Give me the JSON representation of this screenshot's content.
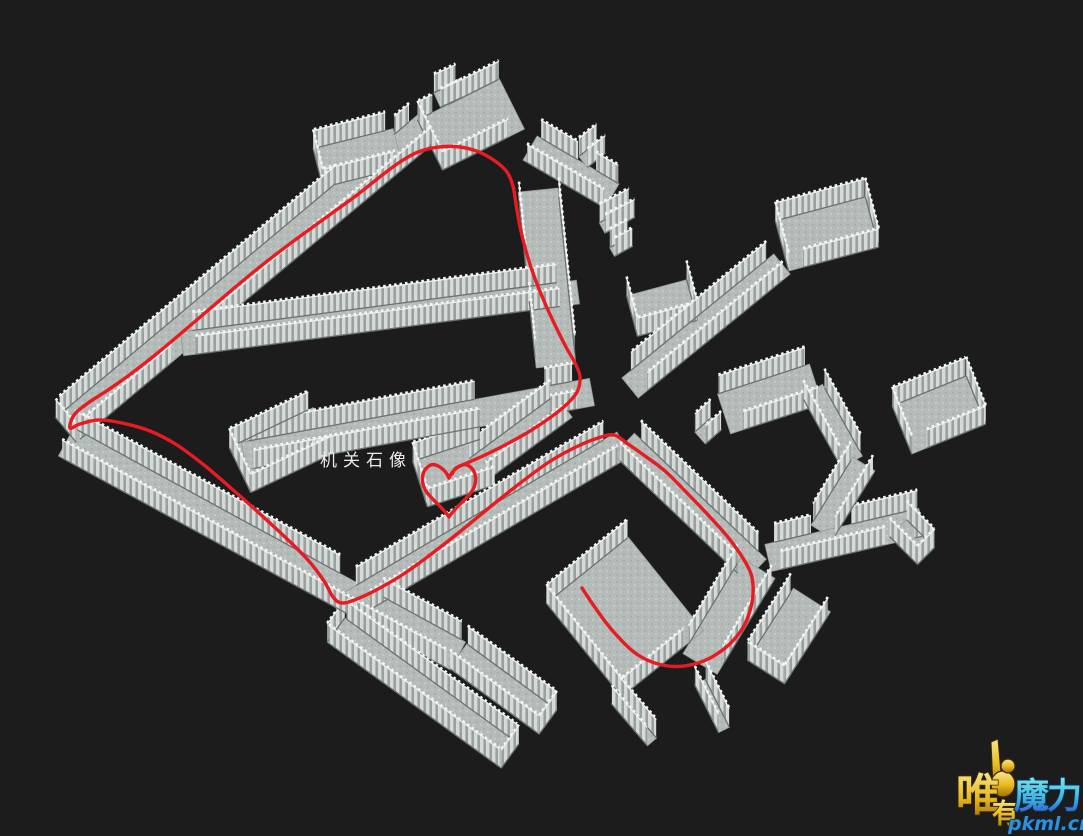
{
  "scene": {
    "width": 1083,
    "height": 836,
    "bg": "#1c1c1c"
  },
  "colors": {
    "background": "#1c1c1c",
    "floor": "#b5bbb8",
    "floor_speckle": "#a8afac",
    "floor_light": "#c3c9c6",
    "floor_edge": "#8d938f",
    "wall_light": "#d6dbd9",
    "wall_dark": "#99a19f",
    "wall_base": "#6b7371",
    "wall_cap": "#e9eceb",
    "wall_knob": "#f4f6f5",
    "route_red": "#e61c22",
    "label_white": "#ececec",
    "wm_url_blue": "#2f8fd8"
  },
  "label": {
    "text": "机关石像"
  },
  "watermark": {
    "char_wei": "唯",
    "char_you": "有",
    "brand": "魔力",
    "site": "pkml.cn"
  },
  "map": {
    "wall_height": 18,
    "segments": [
      {
        "id": "corridor-west-up",
        "a": [
          66,
          430
        ],
        "b": [
          434,
          122
        ],
        "w": 32,
        "capA": true,
        "gL": [
          [
            0.76,
            0.92
          ]
        ],
        "gR": [
          [
            0.26,
            0.37
          ]
        ],
        "tB": 0.04
      },
      {
        "id": "corridor-west-down",
        "a": [
          66,
          442
        ],
        "b": [
          458,
          656
        ],
        "w": 32,
        "gL": [
          [
            0.68,
            0.79
          ]
        ]
      },
      {
        "id": "corridor-bottom-left-1",
        "a": [
          458,
          656
        ],
        "b": [
          548,
          722
        ],
        "w": 30,
        "capB": true
      },
      {
        "id": "corridor-bottom-left-2",
        "a": [
          336,
          630
        ],
        "b": [
          510,
          756
        ],
        "w": 30,
        "capA": true,
        "capB": true
      },
      {
        "id": "corridor-return-branch",
        "a": [
          352,
          604
        ],
        "b": [
          624,
          444
        ],
        "w": 28,
        "tA": 0.04,
        "tB": 0.05
      },
      {
        "id": "room-alcove-nw",
        "a": [
          318,
          168
        ],
        "b": [
          398,
          148
        ],
        "w": 40,
        "capA": true,
        "tB": 0.1
      },
      {
        "id": "room-mid-left",
        "a": [
          240,
          470
        ],
        "b": [
          324,
          430
        ],
        "w": 50,
        "capA": true,
        "tB": 0.06
      },
      {
        "id": "corridor-mid-horizontal",
        "a": [
          244,
          456
        ],
        "b": [
          592,
          392
        ],
        "w": 28,
        "gL": [
          [
            0.67,
            0.87
          ]
        ],
        "gR": [
          [
            0.67,
            0.87
          ]
        ],
        "tA": 0.02,
        "tB": 0.05
      },
      {
        "id": "corridor-mid-upper",
        "a": [
          182,
          344
        ],
        "b": [
          578,
          292
        ],
        "w": 24,
        "tA": 0.03,
        "tB": 0.05
      },
      {
        "id": "room-top",
        "a": [
          430,
          145
        ],
        "b": [
          512,
          104
        ],
        "w": 56,
        "capA": true,
        "gL": [
          [
            0.18,
            0.38
          ]
        ],
        "gR": [
          [
            0.8,
            1
          ]
        ]
      },
      {
        "id": "gate-top-room",
        "a": [
          437,
          100
        ],
        "b": [
          459,
          90
        ],
        "w": 16
      },
      {
        "id": "corridor-top-east",
        "a": [
          530,
          148
        ],
        "b": [
          612,
          196
        ],
        "w": 28,
        "gL": [
          [
            0.5,
            0.72
          ]
        ],
        "tA": 0.05
      },
      {
        "id": "gate-top-east",
        "a": [
          583,
          162
        ],
        "b": [
          601,
          148
        ],
        "w": 14
      },
      {
        "id": "corridor-center-descent",
        "a": [
          538,
          190
        ],
        "b": [
          556,
          366
        ],
        "w": 40,
        "gR": [
          [
            0.45,
            0.62
          ]
        ],
        "tA": 0.05,
        "tB": 0.06
      },
      {
        "id": "wall-cluster-1",
        "a": [
          602,
          228
        ],
        "b": [
          632,
          212
        ],
        "w": 12
      },
      {
        "id": "wall-cluster-2",
        "a": [
          612,
          252
        ],
        "b": [
          630,
          242
        ],
        "w": 10
      },
      {
        "id": "room-c-open",
        "a": [
          632,
          316
        ],
        "b": [
          692,
          300
        ],
        "w": 42,
        "sides": "R",
        "capA": true,
        "capB": true
      },
      {
        "id": "room-top-right",
        "a": [
          782,
          246
        ],
        "b": [
          872,
          222
        ],
        "w": 52,
        "capA": true,
        "capB": true,
        "gR": [
          [
            0,
            0.16
          ]
        ]
      },
      {
        "id": "corridor-tr-descent",
        "a": [
          782,
          264
        ],
        "b": [
          630,
          388
        ],
        "w": 26,
        "tA": 0.05,
        "tB": 0.06
      },
      {
        "id": "room-r3",
        "a": [
          724,
          414
        ],
        "b": [
          816,
          384
        ],
        "w": 42,
        "gR": [
          [
            0,
            0.14
          ]
        ],
        "tB": 0.05
      },
      {
        "id": "nub-r3",
        "a": [
          716,
          424
        ],
        "b": [
          700,
          438
        ],
        "w": 16
      },
      {
        "id": "corridor-r3-east",
        "a": [
          812,
          390
        ],
        "b": [
          852,
          462
        ],
        "w": 24,
        "tA": 0.05,
        "tB": 0.05
      },
      {
        "id": "room-r4",
        "a": [
          902,
          430
        ],
        "b": [
          976,
          400
        ],
        "w": 52,
        "capA": true,
        "capB": true,
        "gR": [
          [
            0,
            0.2
          ]
        ]
      },
      {
        "id": "corridor-r4-door",
        "a": [
          864,
          464
        ],
        "b": [
          822,
          532
        ],
        "w": 26,
        "tA": 0.05,
        "tB": 0.05
      },
      {
        "id": "corridor-x-horizontal",
        "a": [
          768,
          558
        ],
        "b": [
          922,
          522
        ],
        "w": 28,
        "gL": [
          [
            0.3,
            0.56
          ]
        ],
        "gR": [
          [
            0.74,
            0.93
          ]
        ],
        "tA": 0.06
      },
      {
        "id": "stub-x-east",
        "a": [
          898,
          528
        ],
        "b": [
          926,
          556
        ],
        "w": 24,
        "capB": true
      },
      {
        "id": "stub-bottom-right",
        "a": [
          812,
          600
        ],
        "b": [
          766,
          672
        ],
        "w": 44,
        "capB": true,
        "tA": 0.06
      },
      {
        "id": "corridor-se-descent",
        "a": [
          624,
          444
        ],
        "b": [
          756,
          570
        ],
        "w": 30,
        "tA": 0.05,
        "tB": 0.06
      },
      {
        "id": "corridor-junction-south",
        "a": [
          758,
          568
        ],
        "b": [
          700,
          664
        ],
        "w": 40,
        "tA": 0.06,
        "tB": 0.1
      },
      {
        "id": "room-start",
        "a": [
          584,
          650
        ],
        "b": [
          666,
          584
        ],
        "w": 120,
        "capA": true,
        "gR": [
          [
            0.75,
            1
          ]
        ]
      },
      {
        "id": "corridor-heart",
        "a": [
          564,
          406
        ],
        "b": [
          472,
          474
        ],
        "w": 28,
        "tA": 0.06,
        "tB": 0.06
      },
      {
        "id": "room-heart",
        "a": [
          420,
          484
        ],
        "b": [
          488,
          462
        ],
        "w": 48,
        "capA": true
      },
      {
        "id": "wall-fragment-1",
        "a": [
          616,
          700
        ],
        "b": [
          652,
          742
        ],
        "w": 12
      },
      {
        "id": "wall-fragment-2",
        "a": [
          700,
          682
        ],
        "b": [
          724,
          730
        ],
        "w": 12
      }
    ]
  },
  "route": {
    "color": "#e61c22",
    "width": 3.4,
    "heart": {
      "cx": 449,
      "cy": 490,
      "w": 62,
      "h": 54
    },
    "points": [
      [
        582,
        588
      ],
      [
        594,
        606
      ],
      [
        612,
        630
      ],
      [
        638,
        655
      ],
      [
        668,
        666
      ],
      [
        698,
        663
      ],
      [
        724,
        649
      ],
      [
        742,
        629
      ],
      [
        751,
        607
      ],
      [
        753,
        585
      ],
      [
        748,
        567
      ],
      [
        731,
        541
      ],
      [
        710,
        517
      ],
      [
        688,
        494
      ],
      [
        665,
        471
      ],
      [
        645,
        456
      ],
      [
        628,
        444
      ],
      [
        614,
        435
      ],
      [
        598,
        438
      ],
      [
        576,
        447
      ],
      [
        549,
        462
      ],
      [
        519,
        484
      ],
      [
        490,
        507
      ],
      [
        462,
        530
      ],
      [
        434,
        552
      ],
      [
        405,
        573
      ],
      [
        378,
        589
      ],
      [
        357,
        599
      ],
      [
        342,
        603
      ],
      [
        333,
        597
      ],
      [
        324,
        581
      ],
      [
        308,
        560
      ],
      [
        285,
        537
      ],
      [
        259,
        513
      ],
      [
        232,
        489
      ],
      [
        204,
        465
      ],
      [
        177,
        445
      ],
      [
        150,
        431
      ],
      [
        122,
        423
      ],
      [
        98,
        420
      ],
      [
        80,
        424
      ],
      [
        70,
        428
      ],
      [
        74,
        415
      ],
      [
        88,
        403
      ],
      [
        108,
        390
      ],
      [
        132,
        373
      ],
      [
        160,
        351
      ],
      [
        192,
        324
      ],
      [
        226,
        295
      ],
      [
        261,
        266
      ],
      [
        295,
        240
      ],
      [
        328,
        216
      ],
      [
        357,
        195
      ],
      [
        381,
        176
      ],
      [
        400,
        162
      ],
      [
        418,
        152
      ],
      [
        439,
        147
      ],
      [
        460,
        147
      ],
      [
        479,
        152
      ],
      [
        495,
        161
      ],
      [
        507,
        172
      ],
      [
        513,
        186
      ],
      [
        516,
        204
      ],
      [
        520,
        227
      ],
      [
        526,
        251
      ],
      [
        534,
        276
      ],
      [
        544,
        301
      ],
      [
        555,
        325
      ],
      [
        566,
        347
      ],
      [
        575,
        363
      ],
      [
        580,
        377
      ],
      [
        577,
        392
      ],
      [
        567,
        404
      ],
      [
        551,
        417
      ],
      [
        530,
        431
      ],
      [
        507,
        444
      ],
      [
        485,
        455
      ],
      [
        467,
        463
      ],
      [
        456,
        468
      ],
      [
        452,
        474
      ]
    ]
  }
}
